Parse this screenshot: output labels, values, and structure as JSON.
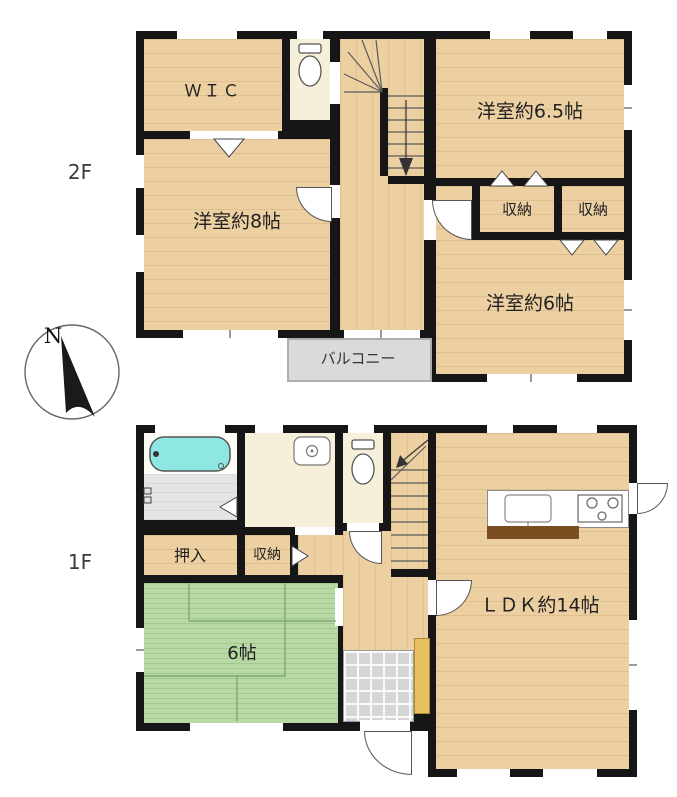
{
  "floors": {
    "f2": {
      "label": "2F",
      "rooms": {
        "wic": "ＷＩＣ",
        "western65": "洋室約6.5帖",
        "closet_left": "収納",
        "closet_right": "収納",
        "western8": "洋室約8帖",
        "western6": "洋室約6帖",
        "balcony": "バルコニー"
      }
    },
    "f1": {
      "label": "1F",
      "rooms": {
        "oshiire": "押入",
        "closet": "収納",
        "tatami6": "6帖",
        "ldk": "ＬＤＫ約14帖"
      }
    }
  },
  "compass": {
    "north": "N"
  },
  "colors": {
    "wall": "#161616",
    "wood_floor": "#ecd0a2",
    "tatami_green": "#b9d9a4",
    "cream_room": "#f6f0da",
    "bathtub_cyan": "#8fe7e3",
    "wet_floor_gray": "#e4e4e4",
    "balcony_gray": "#dadada",
    "entry_tile_gray": "#d6d6d6",
    "shoe_cabinet_yellow": "#eac064",
    "kitchen_counter_brown": "#7a4e20"
  }
}
